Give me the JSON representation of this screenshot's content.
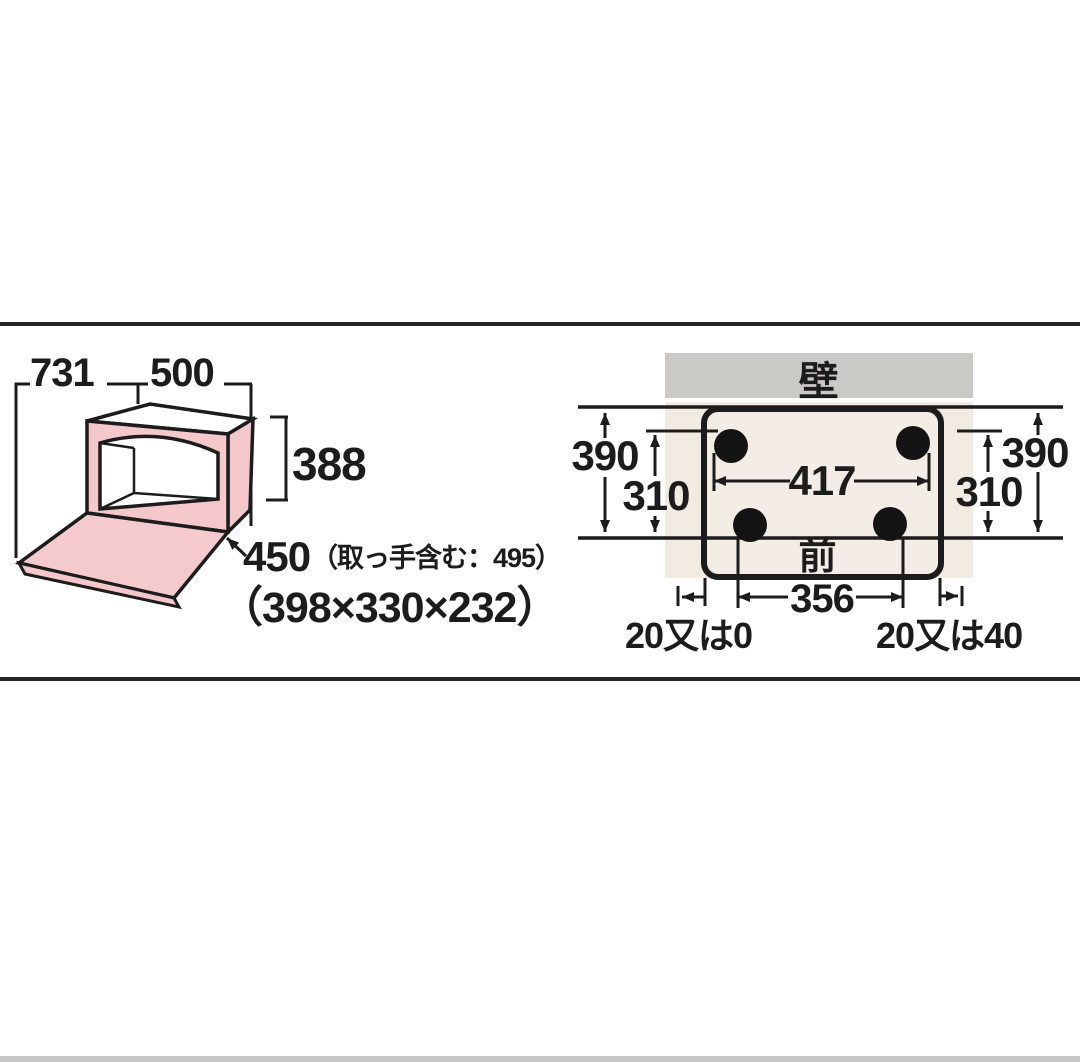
{
  "left_diagram": {
    "overall_width": "731",
    "body_width": "500",
    "body_height": "388",
    "body_depth": "450",
    "depth_note": "（取っ手含む：495）",
    "cavity_dimensions": "（398×330×232）"
  },
  "right_diagram": {
    "wall_label": "壁",
    "front_label": "前",
    "left_wall_to_front": "390",
    "left_feet_pitch": "310",
    "rear_feet_width": "417",
    "right_wall_to_front": "390",
    "right_feet_pitch": "310",
    "front_feet_width": "356",
    "left_clearance": "20又は0",
    "right_clearance": "20又は40"
  },
  "colors": {
    "oven_top_pink": "#f8d2d4",
    "oven_side_pink": "#f4c7ca",
    "oven_door_pink": "#f5cacd",
    "wall_gray": "#cbc9c6",
    "floor_beige": "#f1ebe2",
    "footprint_fill": "#f3ede5",
    "foot_black": "#141414",
    "outline": "#1c1c1c"
  }
}
